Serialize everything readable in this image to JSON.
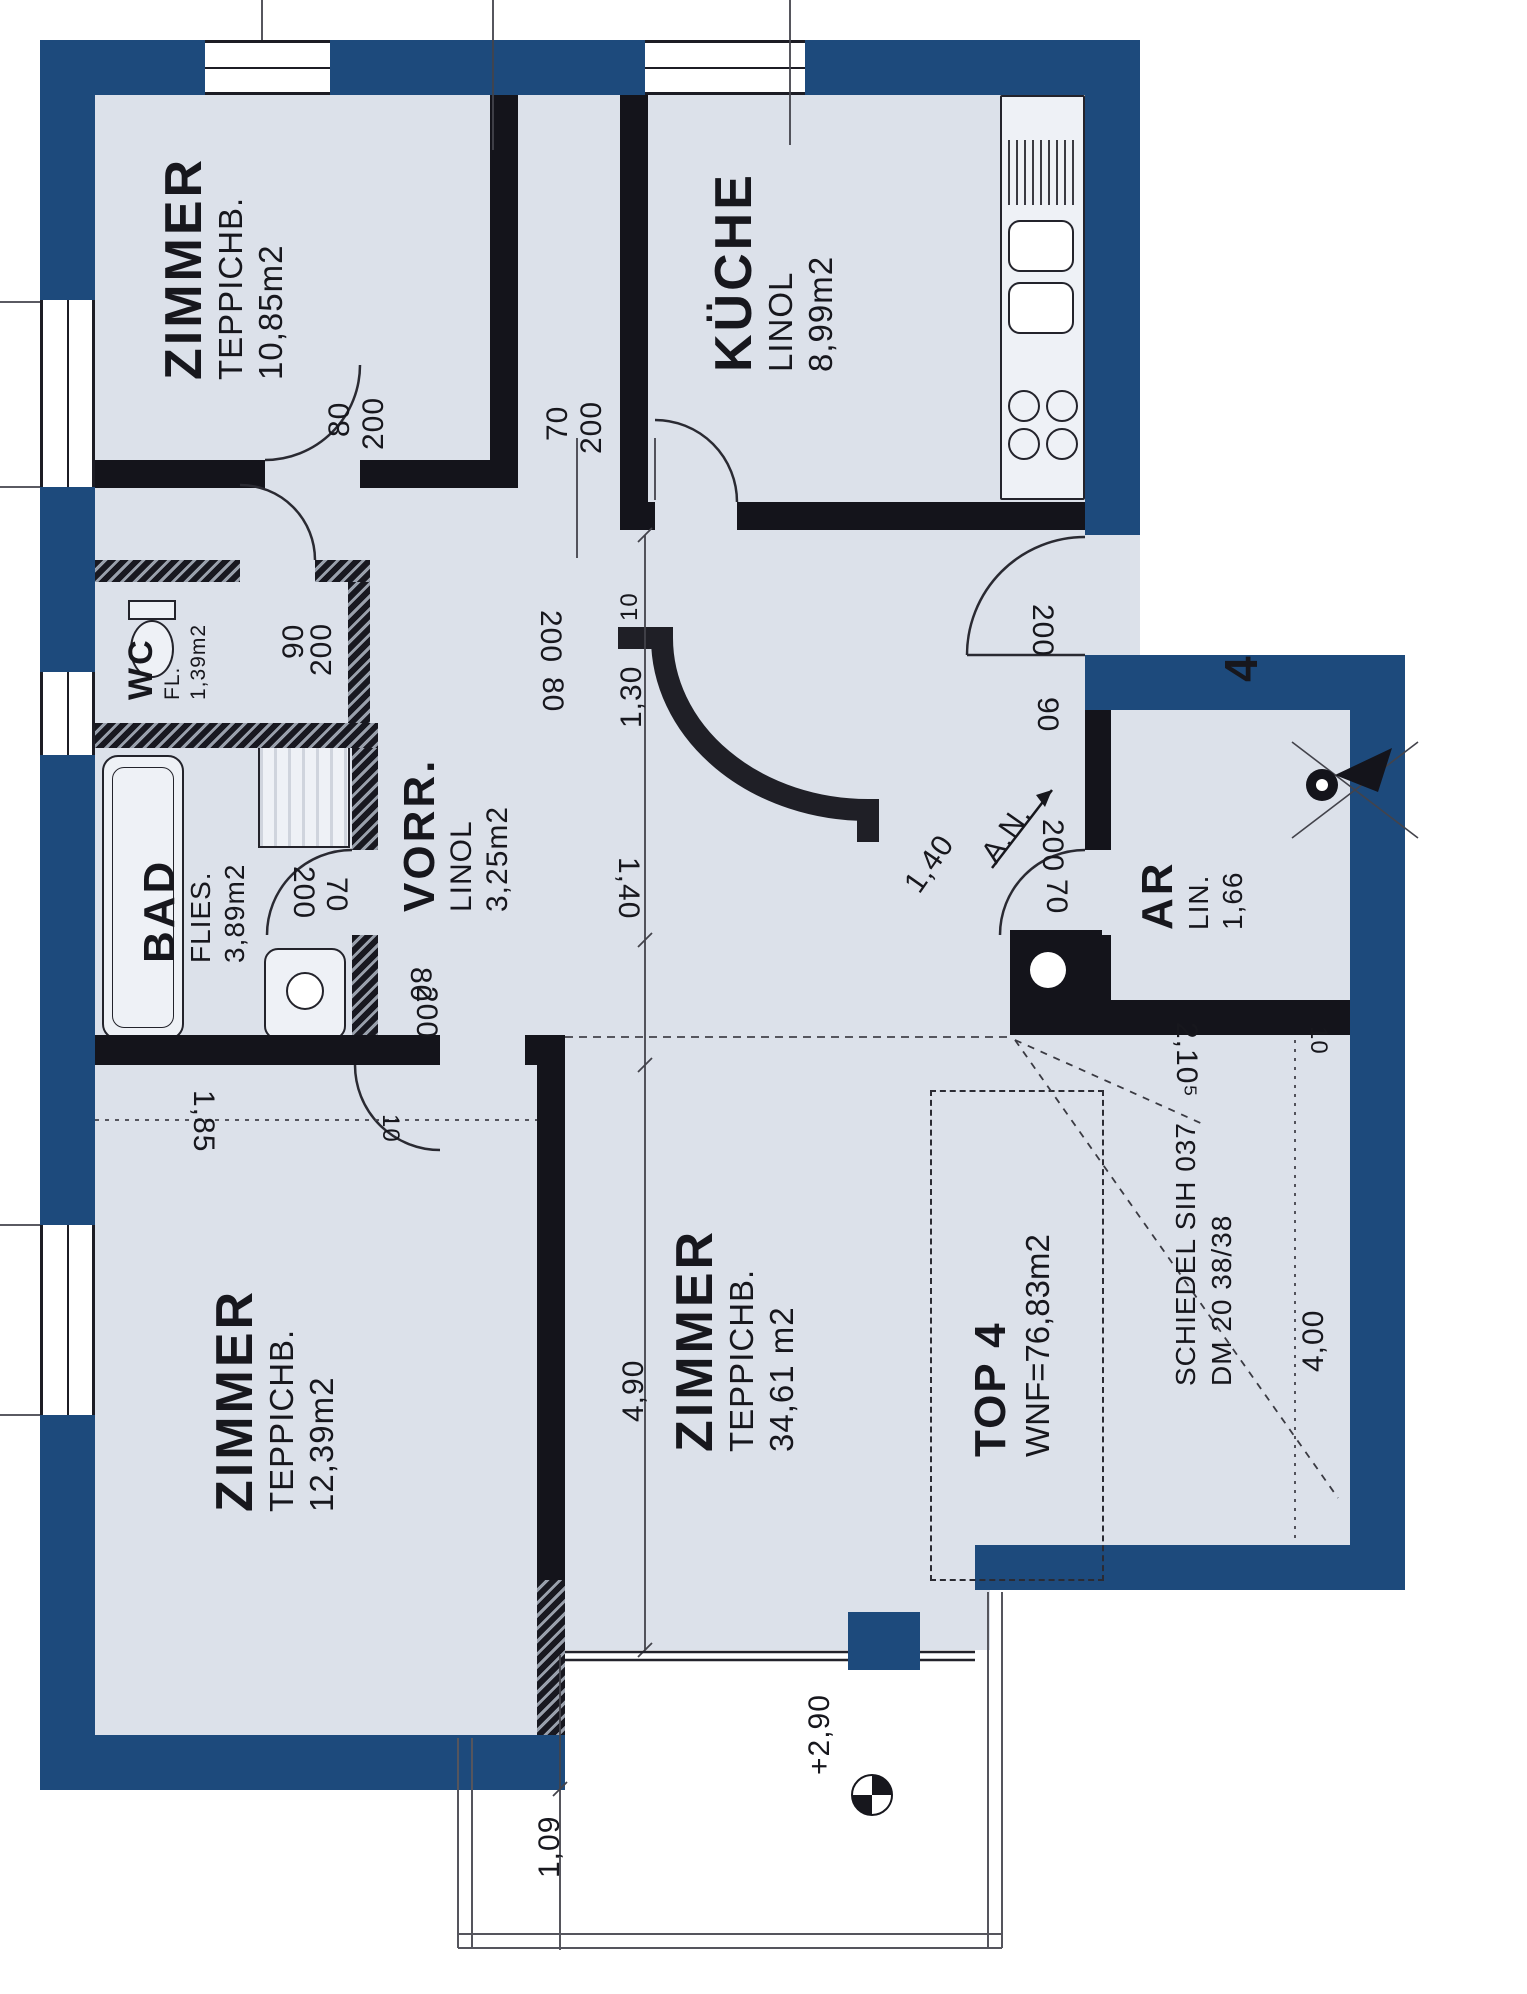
{
  "unit": {
    "number": "4",
    "top": "TOP 4",
    "wnf": "WNF=76,83m2"
  },
  "rooms": {
    "zimmer_top": {
      "name": "ZIMMER",
      "flooring": "TEPPICHB.",
      "area": "10,85m2"
    },
    "kueche": {
      "name": "KÜCHE",
      "flooring": "LINOL",
      "area": "8,99m2"
    },
    "wc": {
      "name": "WC",
      "flooring": "FL.",
      "area": "1,39m2"
    },
    "bad": {
      "name": "BAD",
      "flooring": "FLIES.",
      "area": "3,89m2"
    },
    "vorraum": {
      "name": "VORR.",
      "flooring": "LINOL",
      "area": "3,25m2"
    },
    "zimmer_left": {
      "name": "ZIMMER",
      "flooring": "TEPPICHB.",
      "area": "12,39m2"
    },
    "zimmer_main": {
      "name": "ZIMMER",
      "flooring": "TEPPICHB.",
      "area": "34,61 m2"
    },
    "abstellraum": {
      "name": "AR",
      "flooring": "LIN.",
      "area": "1,66"
    }
  },
  "chimney": {
    "line1": "SCHIEDEL SIH 037",
    "line2": "DM 20  38/38"
  },
  "annotations": {
    "niche": "A.N.",
    "elevation": "+2,90"
  },
  "dims": {
    "zimmer_top_door": [
      "80",
      "200"
    ],
    "kueche_door": [
      "70",
      "200"
    ],
    "wc_door": [
      "90",
      "200"
    ],
    "bad_door": [
      "200",
      "70"
    ],
    "zimmer_left_door": [
      "80",
      "200"
    ],
    "entrance_door": [
      "200",
      "90"
    ],
    "ar_door": [
      "200",
      "70"
    ],
    "corridor": [
      "200",
      "80",
      "1,30",
      "10"
    ],
    "hall": [
      "1,40",
      "4,90"
    ],
    "niche": [
      "1,40"
    ],
    "zimmer_left": [
      "1,85",
      "10"
    ],
    "chimney_zone": [
      "2,10⁵",
      "10",
      "4,00"
    ],
    "terrace": [
      "1,09"
    ]
  }
}
